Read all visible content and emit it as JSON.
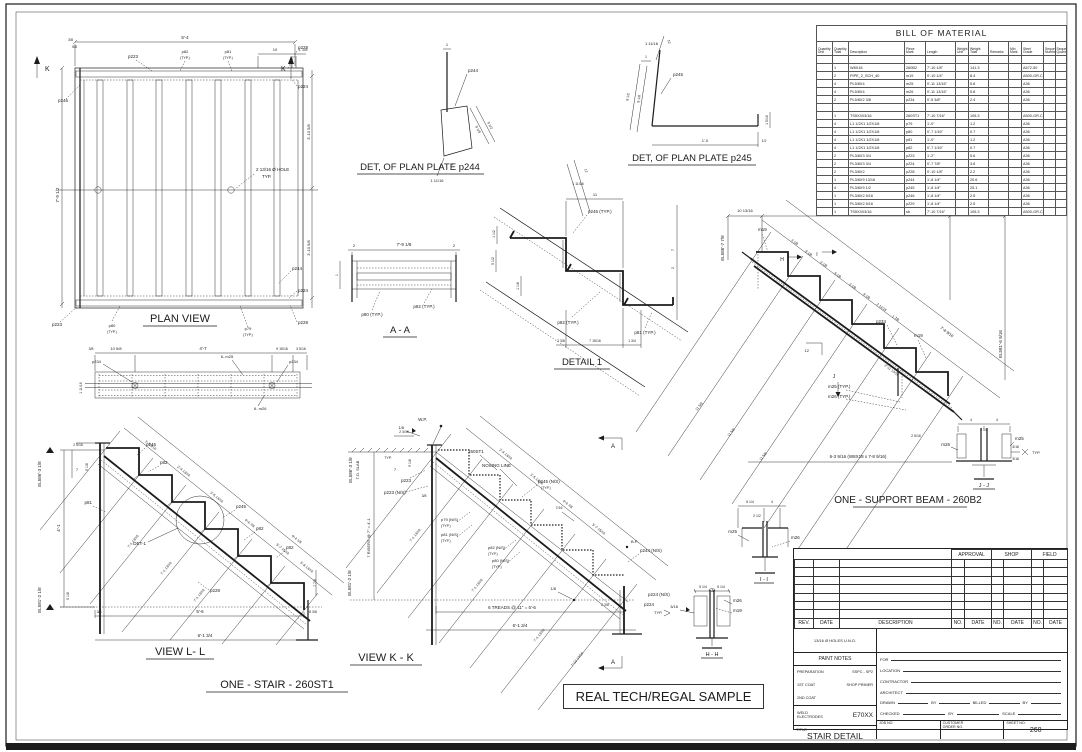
{
  "stamp": {
    "label": "REAL TECH/REGAL SAMPLE"
  },
  "plan": {
    "title": "PLAN VIEW",
    "k": "K",
    "dim_width": "5'-4",
    "dim_left": "7'-9 1/2",
    "dim_right_top": "3'-10 5/8",
    "dim_right_bot": "3'-10 5/8",
    "dim_10": "10",
    "dim_118": "1 1/8",
    "dim_38": "3/8",
    "dim_58": "5/8",
    "p223": "p223",
    "p224": "p224",
    "p228": "p228",
    "p244": "p244",
    "p246": "p246",
    "p79": "p79",
    "p80": "p80",
    "p81": "p81",
    "p82": "p82",
    "typ": "(TYP.)",
    "hole_note_1": "2 13/16 Ø HOLE",
    "hole_note_2": "TYP."
  },
  "det244": {
    "title": "DET, OF PLAN PLATE p244",
    "mark": "p244",
    "d1": "1",
    "d918": "9 1/8",
    "d912": "9 1/2",
    "d12": "12",
    "d11116": "1 11/16"
  },
  "det245": {
    "title": "DET, OF PLAN PLATE p245",
    "mark": "p245",
    "d12": "12",
    "d11116": "1 11/16",
    "d1": "1",
    "d912": "9 1/2",
    "d918": "9 1/8",
    "d10": "1'-0",
    "d12b": "1/2",
    "d1516": "1 5/16"
  },
  "aa": {
    "title": "A - A",
    "d2": "2",
    "dmid": "7'-9 1/8",
    "d1": "1",
    "p80": "p80 (TYP.)",
    "p82": "p82 (TYP.)"
  },
  "detail1": {
    "title": "DETAIL 1",
    "d11": "11",
    "d11116": "1 11/16",
    "d12": "12",
    "p245": "p245 (TYP.)",
    "p82": "p82 (TYP.)",
    "p81": "p81 (TYP.)",
    "d238": "2 3/8",
    "d71516": "7 15/16",
    "d134": "1 3/4",
    "d7": "7",
    "d2": "2",
    "d112": "1 1/2",
    "d512": "5 1/2",
    "d118": "1 1/8"
  },
  "strip": {
    "p234": "p234",
    "m25": "6- m25",
    "m26": "6- m26",
    "d38": "3/8",
    "d1058": "10 5/8",
    "d47": "4'-7",
    "d91516": "9 15/16",
    "d3516": "3 5/16",
    "d11116": "1 11/16"
  },
  "viewll": {
    "title": "VIEW L- L",
    "sub": "ONE - STAIR - 260ST1",
    "el_top": "EL586'-3 1/8",
    "el_bot": "EL581'-2 1/8",
    "d2516": "2 5/16",
    "d918": "9 1/8",
    "d7": "7",
    "d41": "4'-1",
    "d518": "5 1/8",
    "det1": "DET-1",
    "p245": "p245",
    "p82": "p82",
    "p81": "p81",
    "p228": "p228",
    "d38": "3/8",
    "d56": "5'-6",
    "d838": "8 3/8",
    "d6134": "6'-1 3/4",
    "d778": "7 7/8",
    "s1": "1'-3 3/16",
    "s2": "2'-4 13/16",
    "s3": "3'-5 13/16",
    "s4": "4'-6 7/8",
    "s5": "5'-7 15/16",
    "s6": "6'-8 13/16",
    "stot": "8'-4 1/8",
    "long": "7'-1 13/16"
  },
  "viewkk": {
    "title": "VIEW K - K",
    "wp": "W.P.",
    "bp": "B.P.",
    "el_top": "EL586'-3 1/8",
    "tos": "T.O. SLAB",
    "el_bot": "EL581'-2 1/8",
    "risers": "7 RISERS @ 7\" = 4'-1",
    "treads": "6 TREADS @ 11\" = 5'-6",
    "d6134": "6'-1 3/4",
    "st": "260ST1",
    "nosing": "NOSING LINE",
    "p223": "p223",
    "p223ns": "p223  (N/S)",
    "p79": "p79  (N/S)",
    "p81": "p81  (N/S)",
    "p82": "p82  (N/S)",
    "p80": "p80  (N/S)",
    "typ": "(TYP.)",
    "p245": "p245  (N/S)",
    "p244": "p244  (N/S)",
    "p224ns": "p224  (N/S)",
    "p224": "p224",
    "typ2": "TYP.",
    "a": "A",
    "w18": "1/8",
    "d238": "2 3/8",
    "d38": "3/8",
    "d2316": "2 3/16",
    "d7": "7",
    "dtyp": "TYP.",
    "d918": "9 1/8",
    "d716": "7/16",
    "s1": "2'-4 13/16",
    "s2": "3'-5 13/16",
    "s3": "4'-6 7/8",
    "s4": "5'-7 15/16",
    "long": "7'-1 13/16",
    "long2": "7'-10 13/16"
  },
  "beam": {
    "title": "ONE - SUPPORT BEAM - 260B2",
    "d1": "10 13/16",
    "d2": "4'-2",
    "d3": "1'-1 1/8",
    "el_top": "EL586'-7 7/8",
    "el_bot": "EL581'-6 9/16",
    "m19": "m19",
    "p234": "p234",
    "m25": "m25  (TYP.)",
    "m26": "m26  (TYP.)",
    "d12": "12",
    "h": "H",
    "i": "I",
    "j": "J",
    "note": "6-3 9/16  (W8X18 x 7-8 9/16)",
    "sa": "3 1/8",
    "sb": "9 1/8",
    "s7": "2 11/16",
    "s8": "1 7/8",
    "stot": "7'-8 9/16",
    "d21113": "2'-11 13/16",
    "long": "11 5/8",
    "d2516": "2 5/16"
  },
  "hh": {
    "title": "H - H",
    "m26": "m26",
    "m19": "m19",
    "w": "3/16",
    "d": "5 1/4"
  },
  "ii": {
    "title": "I - I",
    "m25": "m25",
    "m26": "m26",
    "d614": "6 1/4",
    "d4": "4",
    "d212": "2 1/2"
  },
  "jj": {
    "title": "J - J",
    "m25": "m25",
    "m26": "m26",
    "d4": "4",
    "d212": "2 1/2",
    "w": "3/16",
    "typ": "TYP."
  },
  "bom": {
    "title": "BILL OF MATERIAL",
    "headers": [
      [
        "Quantity",
        "Unit"
      ],
      [
        "Quantity",
        "Total"
      ],
      [
        "Description",
        ""
      ],
      [
        "Piece",
        "Mark"
      ],
      [
        "Length",
        ""
      ],
      [
        "Weight",
        "Unit"
      ],
      [
        "Weight",
        "Total"
      ],
      [
        "Remarks",
        ""
      ],
      [
        "Min",
        "Mark"
      ],
      [
        "Steel",
        "Grade"
      ],
      [
        "Sequence",
        "Numbers"
      ],
      [
        "Sequence",
        "Quantity"
      ]
    ],
    "rows": [
      [
        "",
        "",
        "",
        "",
        "",
        "",
        "",
        "",
        "",
        "",
        "",
        ""
      ],
      [
        "",
        "1",
        "W8X18",
        "260B2",
        "7'-10 1/8\"",
        "",
        "141.3",
        "",
        "",
        "A572-50",
        "",
        ""
      ],
      [
        "",
        "2",
        "PIPE_2_SCH_40",
        "m19",
        "0'-10 1/4\"",
        "",
        "8.4",
        "",
        "",
        "A500-GR.C",
        "",
        ""
      ],
      [
        "",
        "4",
        "PL5/8X4",
        "m25",
        "0'-11 13/16\"",
        "",
        "5.8",
        "",
        "",
        "A36",
        "",
        ""
      ],
      [
        "",
        "4",
        "PL5/8X4",
        "m26",
        "0'-11 13/16\"",
        "",
        "5.8",
        "",
        "",
        "A36",
        "",
        ""
      ],
      [
        "",
        "2",
        "PL5/8X2 3/8",
        "p234",
        "0'-5 3/8\"",
        "",
        "2.4",
        "",
        "",
        "A36",
        "",
        ""
      ],
      [
        "",
        "",
        "",
        "",
        "",
        "",
        "",
        "",
        "",
        "",
        "",
        ""
      ],
      [
        "",
        "1",
        "TS5X3X3/16",
        "260ST1",
        "7'-10 7/16\"",
        "",
        "105.3",
        "",
        "",
        "A500-GR.C",
        "",
        ""
      ],
      [
        "",
        "4",
        "L1 1/2X1 1/2X1/8",
        "p79",
        "1'-0\"",
        "",
        "1.2",
        "",
        "",
        "A36",
        "",
        ""
      ],
      [
        "",
        "4",
        "L1 1/2X1 1/2X1/8",
        "p80",
        "0'-7 1/16\"",
        "",
        "0.7",
        "",
        "",
        "A36",
        "",
        ""
      ],
      [
        "",
        "4",
        "L1 1/2X1 1/2X1/8",
        "p81",
        "1'-0\"",
        "",
        "1.2",
        "",
        "",
        "A36",
        "",
        ""
      ],
      [
        "",
        "4",
        "L1 1/2X1 1/2X1/8",
        "p82",
        "0'-7 1/16\"",
        "",
        "0.7",
        "",
        "",
        "A36",
        "",
        ""
      ],
      [
        "",
        "2",
        "PL3/8X3 3/4",
        "p223",
        "1'-2\"",
        "",
        "5.6",
        "",
        "",
        "A36",
        "",
        ""
      ],
      [
        "",
        "2",
        "PL3/8X3 3/4",
        "p224",
        "0'-7 7/8\"",
        "",
        "3.8",
        "",
        "",
        "A36",
        "",
        ""
      ],
      [
        "",
        "2",
        "PL3/8X2",
        "p228",
        "0'-10 1/8\"",
        "",
        "2.2",
        "",
        "",
        "A36",
        "",
        ""
      ],
      [
        "",
        "1",
        "PL3/8X9 13/16",
        "p244",
        "1'-8 1/4\"",
        "",
        "20.6",
        "",
        "",
        "A36",
        "",
        ""
      ],
      [
        "",
        "4",
        "PL3/8X9 1/2",
        "p245",
        "1'-8 1/4\"",
        "",
        "25.1",
        "",
        "",
        "A36",
        "",
        ""
      ],
      [
        "",
        "1",
        "PL3/8X2 5/16",
        "p246",
        "1'-8 1/4\"",
        "",
        "2.5",
        "",
        "",
        "A36",
        "",
        ""
      ],
      [
        "",
        "1",
        "PL3/8X2 5/16",
        "p229",
        "1'-8 1/4\"",
        "",
        "2.5",
        "",
        "",
        "A36",
        "",
        ""
      ],
      [
        "",
        "1",
        "TS5X3X3/16",
        "sb",
        "7'-10 7/16\"",
        "",
        "105.3",
        "",
        "",
        "A500-GR.C",
        "",
        ""
      ]
    ]
  },
  "tb": {
    "approval": "APPROVAL",
    "shop": "SHOP",
    "field": "FIELD",
    "rev": "REV.",
    "date": "DATE",
    "desc": "DESCRIPTION",
    "no": "NO.",
    "rev_rows": [
      [
        "",
        "",
        "",
        "",
        "",
        "",
        "",
        "",
        ""
      ],
      [
        "",
        "",
        "",
        "",
        "",
        "",
        "",
        "",
        ""
      ],
      [
        "",
        "",
        "",
        "",
        "",
        "",
        "",
        "",
        ""
      ],
      [
        "",
        "",
        "",
        "",
        "",
        "",
        "",
        "",
        ""
      ],
      [
        "",
        "",
        "",
        "",
        "",
        "",
        "",
        "",
        ""
      ],
      [
        "",
        "",
        "",
        "",
        "",
        "",
        "",
        "",
        ""
      ],
      [
        "",
        "",
        "",
        "",
        "",
        "",
        "",
        "",
        ""
      ]
    ],
    "holes": "13/16 Ø HOLES U.N.O.",
    "paint": "PAINT NOTES",
    "prep": "PREPARATION",
    "prep_v": "SSPC - SP2",
    "coat1": "1ST COAT",
    "coat1_v": "SHOP PRIMER",
    "coat2": "2ND COAT",
    "coat2_v": "",
    "weld1": "WELD",
    "weld2": "ELECTRODES",
    "weld_v": "E70XX",
    "title_l": "TITLE",
    "title_v": "STAIR DETAIL",
    "for": "FOR",
    "loc": "LOCATION",
    "contr": "CONTRACTOR",
    "arch": "ARCHITECT",
    "drawn": "DRAWN",
    "by": "BY",
    "billed": "BILLED",
    "checked": "CHECKED",
    "scale": "SCALE",
    "job": "JOB NO.",
    "cust1": "CUSTOMER",
    "cust2": "ORDER NO.",
    "sheet_l": "SHEET NO.",
    "sheet_v": "260"
  }
}
